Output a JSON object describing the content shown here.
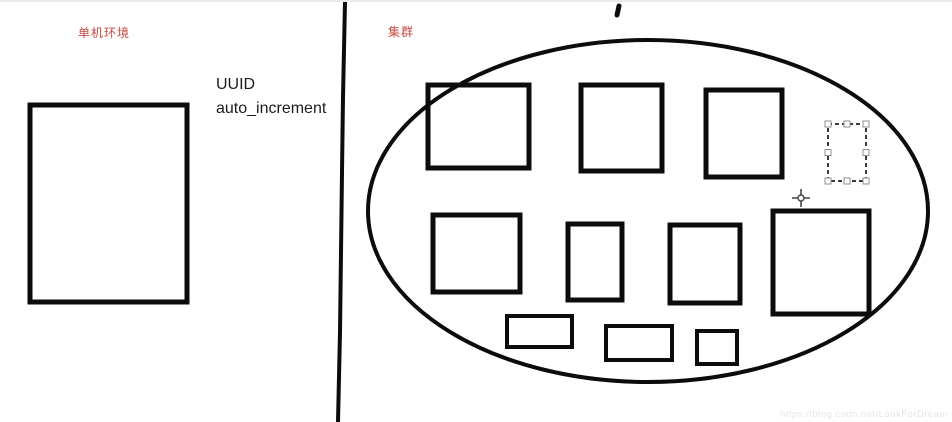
{
  "canvas": {
    "width": 952,
    "height": 420,
    "background": "#ffffff"
  },
  "labels": {
    "left_section": "单机环境",
    "right_section": "集群",
    "uuid": "UUID",
    "auto_increment": "auto_increment"
  },
  "watermark": "https://blog.csdn.net/LookForDream",
  "colors": {
    "ink": "#0c0c0c",
    "annotation_red": "#c64a42",
    "selection_dash": "#3a3a3a",
    "handle_fill": "#ffffff",
    "handle_border": "#8f8f8f",
    "cursor": "#444444",
    "watermark_gray": "#e2e6e1"
  },
  "shapes": {
    "divider": {
      "points": "345,0 343,95 342,170 341,250 340,330 338,420",
      "stroke_width": 4
    },
    "left_rect": {
      "x": 30,
      "y": 103,
      "w": 157,
      "h": 197,
      "sw": 5
    },
    "ellipse": {
      "cx": 648,
      "cy": 209,
      "rx": 280,
      "ry": 171,
      "sw": 4
    },
    "cluster_rects": [
      {
        "x": 428,
        "y": 83,
        "w": 101,
        "h": 83,
        "sw": 5
      },
      {
        "x": 581,
        "y": 83,
        "w": 81,
        "h": 86,
        "sw": 5
      },
      {
        "x": 706,
        "y": 88,
        "w": 76,
        "h": 87,
        "sw": 5
      },
      {
        "x": 433,
        "y": 213,
        "w": 87,
        "h": 77,
        "sw": 5
      },
      {
        "x": 568,
        "y": 222,
        "w": 54,
        "h": 76,
        "sw": 5
      },
      {
        "x": 670,
        "y": 223,
        "w": 70,
        "h": 78,
        "sw": 5
      },
      {
        "x": 773,
        "y": 209,
        "w": 96,
        "h": 103,
        "sw": 5
      },
      {
        "x": 507,
        "y": 314,
        "w": 65,
        "h": 31,
        "sw": 4
      },
      {
        "x": 606,
        "y": 324,
        "w": 66,
        "h": 34,
        "sw": 4
      },
      {
        "x": 697,
        "y": 329,
        "w": 40,
        "h": 33,
        "sw": 4
      }
    ],
    "selected_rect": {
      "x": 828,
      "y": 122,
      "w": 38,
      "h": 57
    },
    "pen_mark": {
      "x1": 619,
      "y1": 4,
      "x2": 617,
      "y2": 13,
      "sw": 5
    }
  },
  "cursor": {
    "x": 801,
    "y": 196,
    "arm": 9,
    "radius": 3
  }
}
